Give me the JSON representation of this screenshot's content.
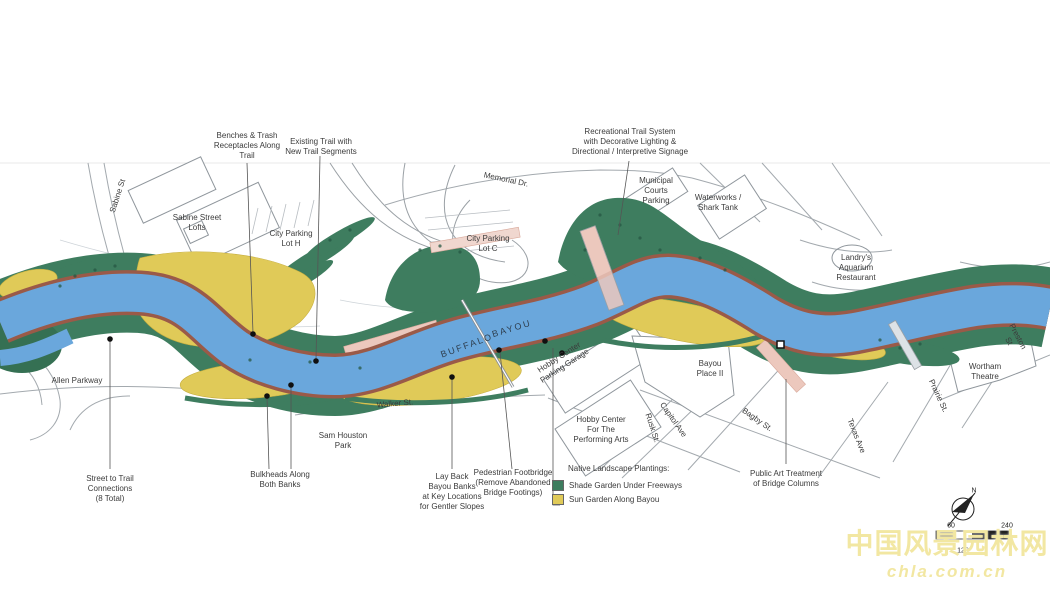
{
  "colors": {
    "bayou_water": "#6aa7dc",
    "shade_garden": "#3e7d5f",
    "sun_garden": "#e0ca58",
    "plaza_pink": "#ecc8bd",
    "bank_edge": "#9a5a48",
    "line_work": "#a3a9ae",
    "watermark": "#f2e7a2"
  },
  "callouts": {
    "benches": "Benches & Trash\nReceptacles Along\nTrail",
    "existing_trail": "Existing Trail with\nNew Trail Segments",
    "recreational": "Recreational Trail System\nwith Decorative Lighting &\nDirectional / Interpretive Signage",
    "street_to_trail": "Street to Trail\nConnections\n(8 Total)",
    "bulkheads": "Bulkheads Along\nBoth Banks",
    "lay_back": "Lay Back\nBayou Banks\nat Key Locations\nfor Gentler Slopes",
    "footbridge": "Pedestrian Footbridge\n(Remove Abandoned\nBridge Footings)",
    "public_art": "Public Art Treatment\nof Bridge Columns"
  },
  "legend": {
    "title": "Native Landscape Plantings:",
    "items": [
      {
        "label": "Shade Garden Under Freeways",
        "color": "#3e7d5f"
      },
      {
        "label": "Sun Garden Along Bayou",
        "color": "#e0ca58"
      }
    ]
  },
  "map_labels": {
    "sabine_st": "Sabine St",
    "sabine_lofts": "Sabine Street\nLofts",
    "lot_h": "City Parking\nLot H",
    "memorial_dr": "Memorial Dr.",
    "lot_c": "City Parking\nLot C",
    "municipal_courts": "Municipal\nCourts\nParking",
    "waterworks": "Waterworks /\nShark Tank",
    "landrys": "Landry's\nAquarium\nRestaurant",
    "buffalo": "BUFFALO",
    "bayou": "BAYOU",
    "hobby_garage": "Hobby Center\nParking Garage",
    "bayou_place": "Bayou\nPlace II",
    "hobby_center": "Hobby Center\nFor The\nPerforming Arts",
    "sam_houston": "Sam Houston\nPark",
    "allen_parkway": "Allen Parkway",
    "walker": "Walker St.",
    "capitol": "Capitol Ave",
    "rusk": "Rusk St.",
    "bagby": "Bagby St.",
    "texas": "Texas Ave",
    "preston": "Preston St",
    "prairie": "Prairie St.",
    "wortham": "Wortham\nTheatre"
  },
  "compass": {
    "north": "N"
  },
  "scale_bar": {
    "tick_60": "60",
    "tick_240": "240",
    "tick_120": "120"
  },
  "watermark": {
    "text_cn": "中国风景园林网",
    "text_url": "chla.com.cn"
  }
}
